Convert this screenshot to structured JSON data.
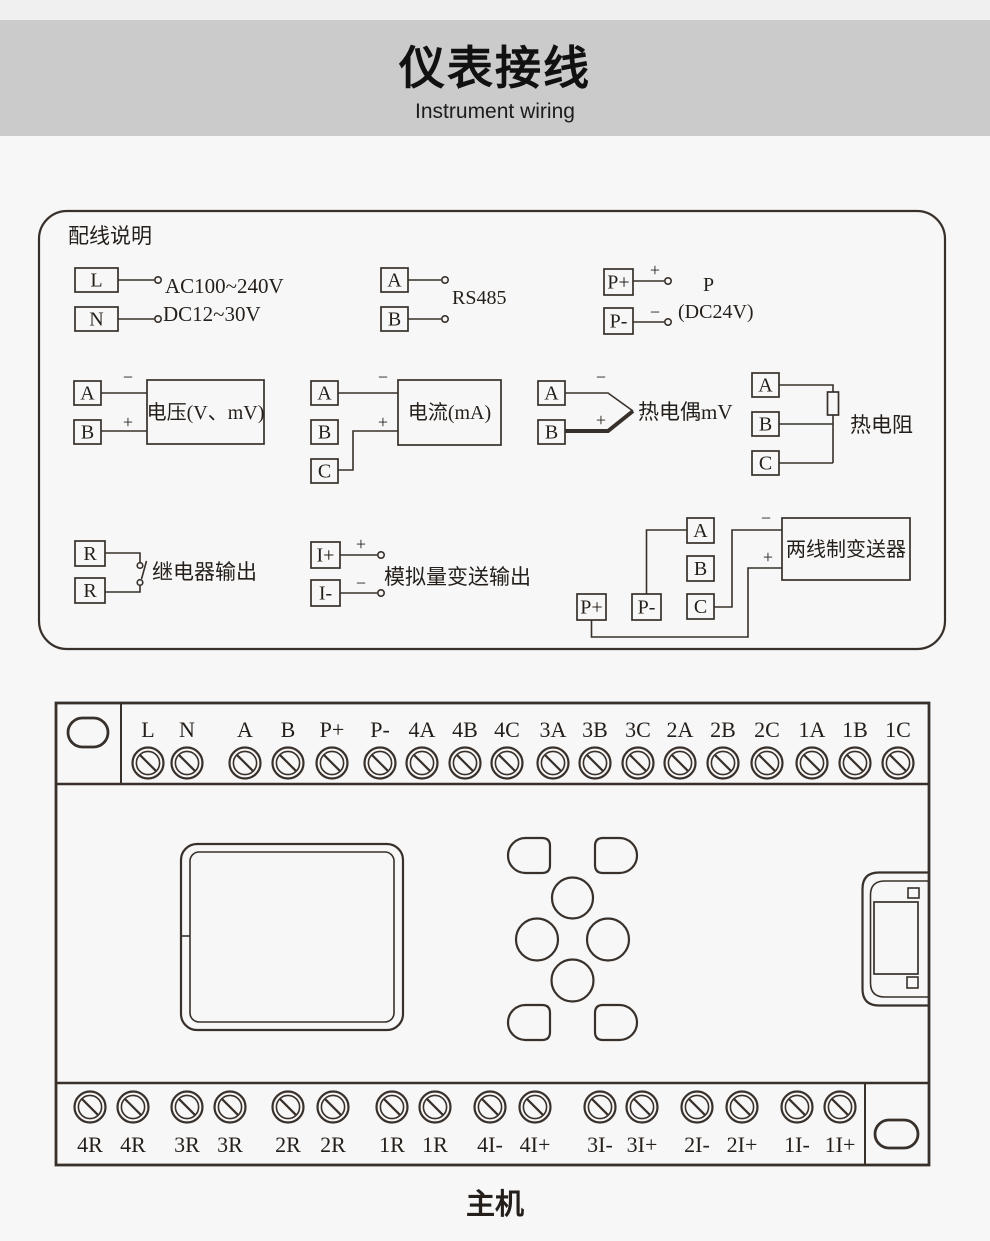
{
  "header": {
    "title": "仪表接线",
    "subtitle": "Instrument wiring"
  },
  "wiring_box": {
    "title": "配线说明",
    "power": {
      "t1": "L",
      "t2": "N",
      "label1": "AC100~240V",
      "label2": "DC12~30V"
    },
    "rs485": {
      "t1": "A",
      "t2": "B",
      "label": "RS485"
    },
    "aux": {
      "t1": "P+",
      "t2": "P-",
      "plus": "+",
      "minus": "−",
      "label1": "P",
      "label2": "(DC24V)"
    },
    "voltage": {
      "t1": "A",
      "t2": "B",
      "minus": "−",
      "plus": "+",
      "label": "电压(V、mV)"
    },
    "current": {
      "t1": "A",
      "t2": "B",
      "t3": "C",
      "minus": "−",
      "plus": "+",
      "label": "电流(mA)"
    },
    "tc": {
      "t1": "A",
      "t2": "B",
      "minus": "−",
      "plus": "+",
      "label": "热电偶mV"
    },
    "rtd": {
      "t1": "A",
      "t2": "B",
      "t3": "C",
      "label": "热电阻"
    },
    "relay": {
      "t1": "R",
      "t2": "R",
      "label": "继电器输出"
    },
    "analog": {
      "t1": "I+",
      "t2": "I-",
      "plus": "+",
      "minus": "−",
      "label": "模拟量变送输出"
    },
    "tx": {
      "a": "A",
      "b": "B",
      "c": "C",
      "pp": "P+",
      "pm": "P-",
      "minus": "−",
      "plus": "+",
      "label": "两线制变送器"
    }
  },
  "device": {
    "top_terminals": [
      "L",
      "N",
      "A",
      "B",
      "P+",
      "P-",
      "4A",
      "4B",
      "4C",
      "3A",
      "3B",
      "3C",
      "2A",
      "2B",
      "2C",
      "1A",
      "1B",
      "1C"
    ],
    "bottom_terminals": [
      "4R",
      "4R",
      "3R",
      "3R",
      "2R",
      "2R",
      "1R",
      "1R",
      "4I-",
      "4I+",
      "3I-",
      "3I+",
      "2I-",
      "2I+",
      "1I-",
      "1I+"
    ],
    "caption": "主机"
  },
  "colors": {
    "page_bg": "#f8f7f7",
    "header_band": "#cbcbcb",
    "line": "#38302a"
  }
}
